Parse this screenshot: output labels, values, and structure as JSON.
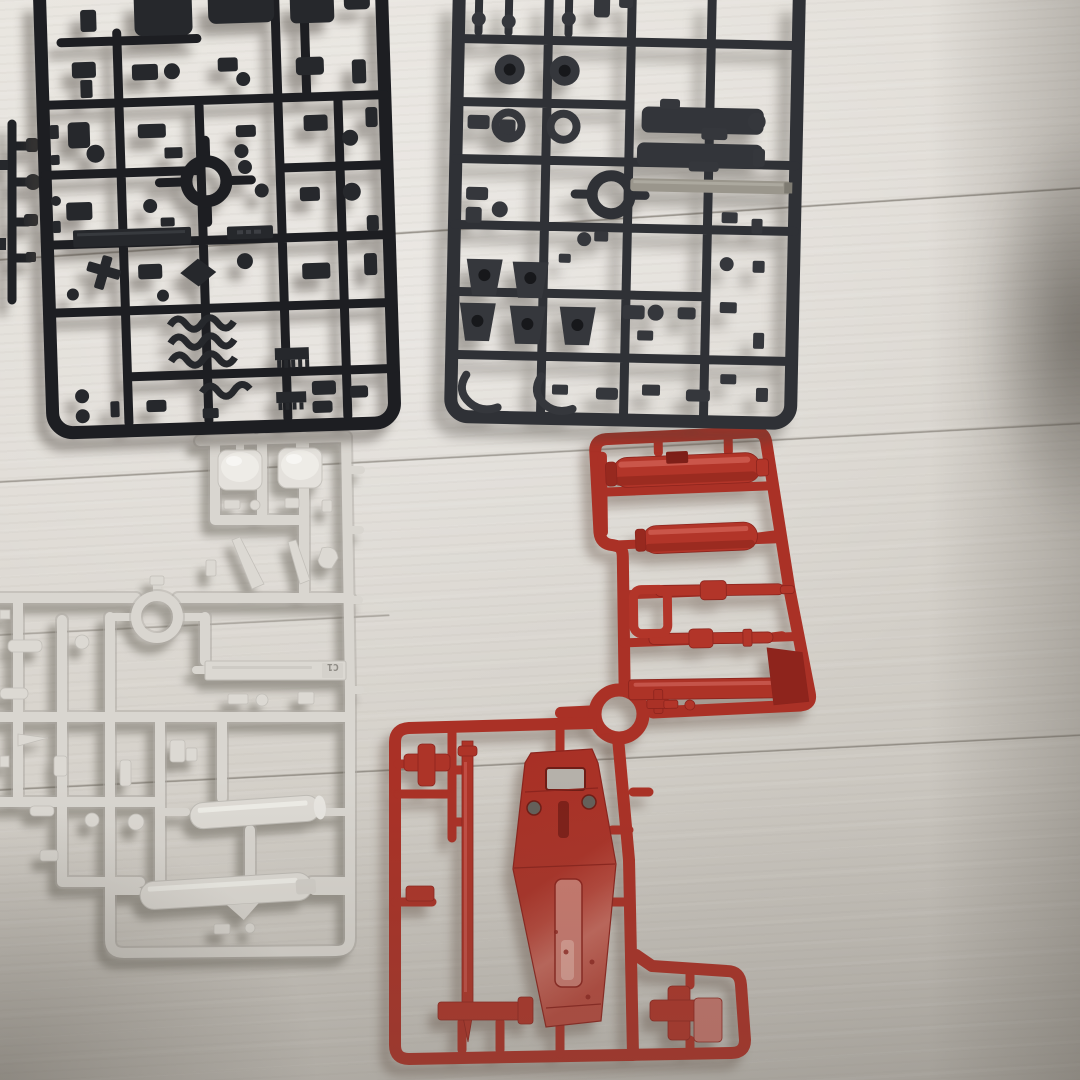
{
  "scene": {
    "kind": "photograph",
    "subject": "Plastic model kit part runners (sprues) laid out on a light wooden floor",
    "floor": {
      "base_color": "#dcd8d2",
      "seam_color": "#8a857c",
      "visible_plank_seams": 4
    },
    "right_edge_shadow_color": "#6a665f"
  },
  "runners": {
    "black_top_left": {
      "label": "black runner with small frame and joint parts",
      "color": "#202226"
    },
    "black_fragment_left_edge": {
      "label": "black runner fragment cut by photo edge",
      "color": "#202226"
    },
    "dark_gray_top_right": {
      "label": "dark gray runner with ball joints and weapon parts",
      "color": "#303237",
      "metal_rod_color": "#9a968c"
    },
    "light_gray_center_left": {
      "label": "light gray runner with head domes and cylinder parts",
      "color": "#d9d6d0",
      "tag": "C1"
    },
    "red_upper": {
      "label": "red runner with bazooka and rifle parts",
      "color": "#b23529"
    },
    "red_lower": {
      "label": "red runner with shield, beam rod and vernier parts",
      "color": "#ad3428"
    }
  }
}
